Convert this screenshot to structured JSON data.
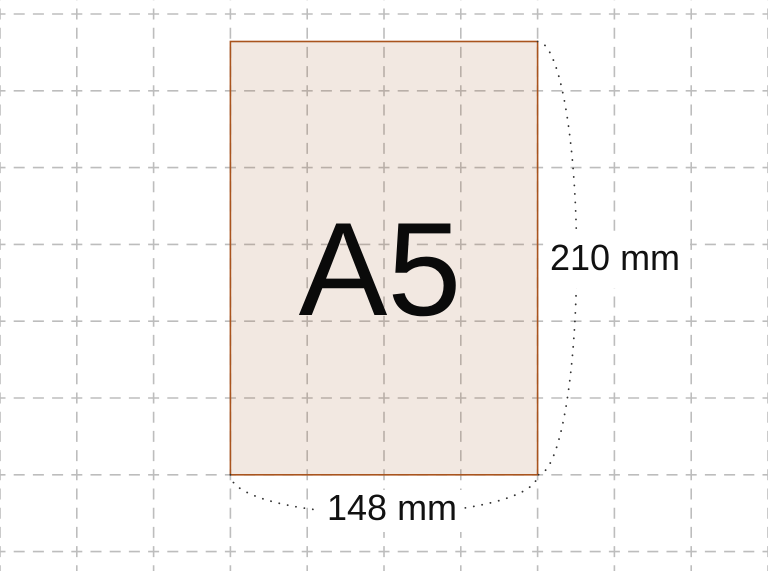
{
  "diagram": {
    "title": "A5",
    "height_label": "210 mm",
    "width_label": "148 mm"
  },
  "colors": {
    "background": "#ffffff",
    "grid_line": "#bdbdbd",
    "sheet_fill_tint": "#a65a2d",
    "sheet_border": "#a9541e",
    "dimension_dots": "#333333",
    "label_text": "#111111"
  }
}
